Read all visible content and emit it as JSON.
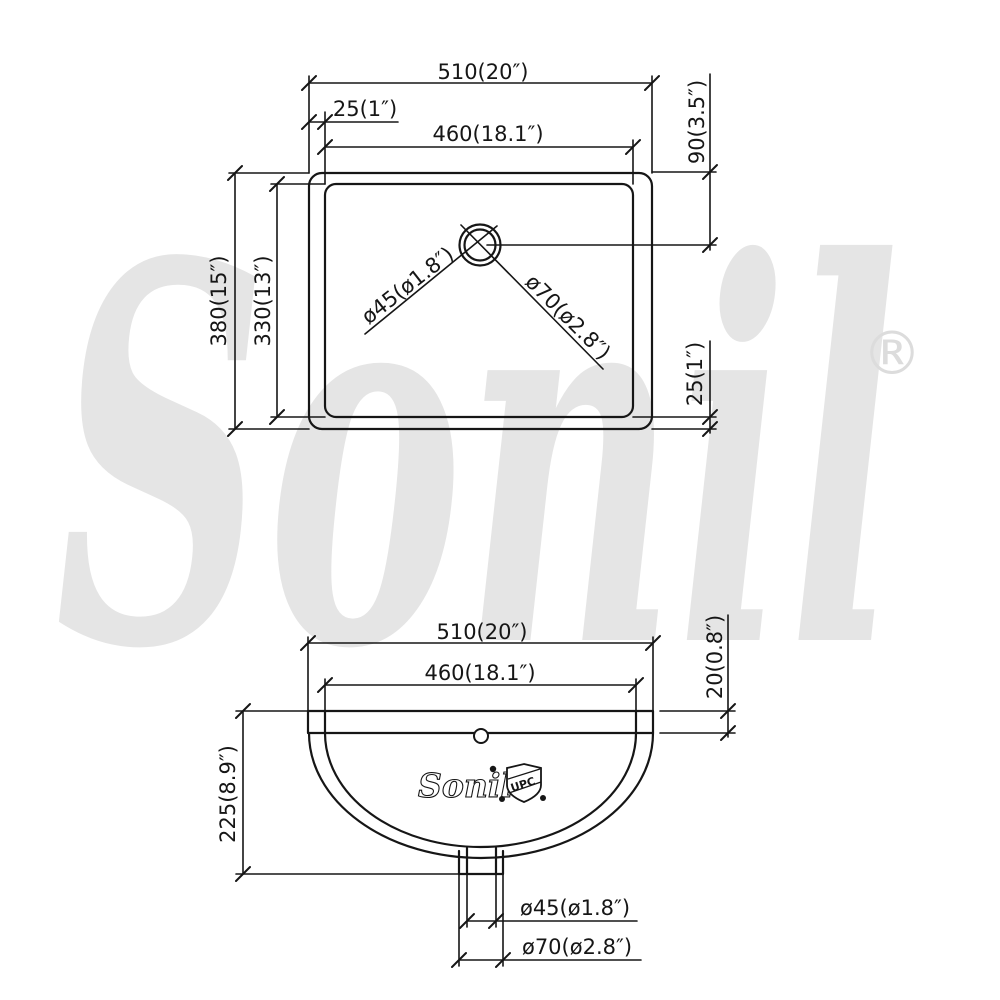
{
  "watermark": {
    "brand": "Sonil",
    "registered_mark": "®"
  },
  "top_view": {
    "dim_overall_width": "510(20″)",
    "dim_rim_to_basin_offset": "25(1″)",
    "dim_basin_width": "460(18.1″)",
    "dim_drain_from_back_edge": "90(3.5″)",
    "dim_overall_depth": "380(15″)",
    "dim_basin_depth": "330(13″)",
    "dim_rim_to_basin_offset_front": "25(1″)",
    "dim_drain_inner_dia": "ø45(ø1.8″)",
    "dim_drain_outer_dia": "ø70(ø2.8″)"
  },
  "front_view": {
    "dim_overall_width": "510(20″)",
    "dim_basin_width": "460(18.1″)",
    "dim_rim_thickness": "20(0.8″)",
    "dim_overall_height": "225(8.9″)",
    "dim_drain_inner_dia": "ø45(ø1.8″)",
    "dim_drain_outer_dia": "ø70(ø2.8″)",
    "logo_brand": "Sonil",
    "logo_certification": "UPC"
  }
}
